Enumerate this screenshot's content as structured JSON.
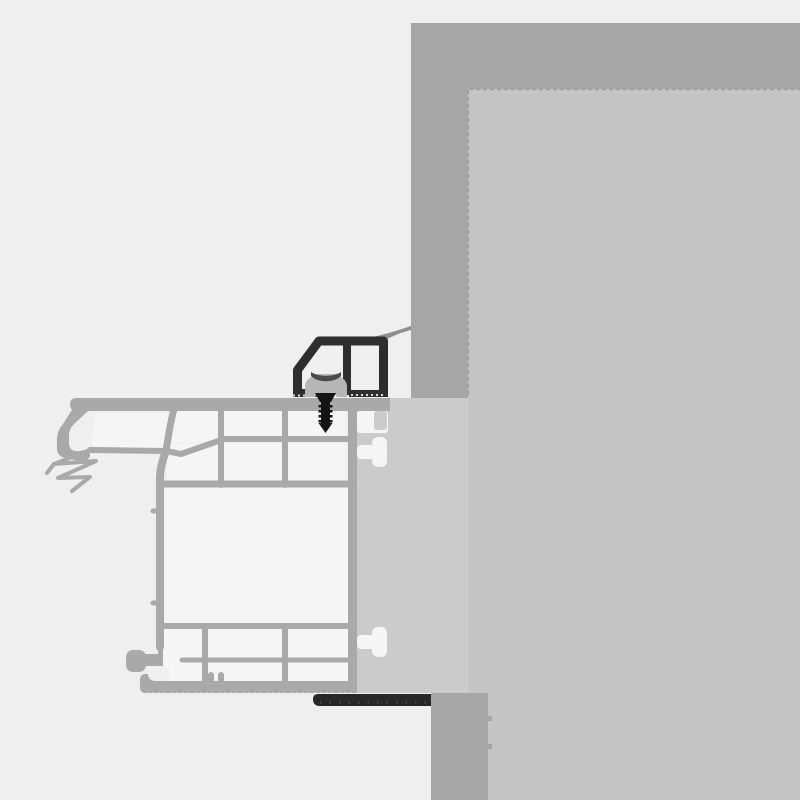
{
  "diagram": {
    "title": "Window frame to wall installation cross-section",
    "type": "technical-section-drawing",
    "text_labels": [],
    "components": [
      {
        "id": "wall",
        "label": "masonry wall"
      },
      {
        "id": "wall-reveal-band",
        "label": "wall reveal plaster band"
      },
      {
        "id": "gap-filler",
        "label": "installation gap filler between frame and wall"
      },
      {
        "id": "window-frame-profile",
        "label": "multi-chamber window frame profile"
      },
      {
        "id": "rebate-gasket",
        "label": "rebate sealing gasket"
      },
      {
        "id": "mounting-bracket",
        "label": "installation mounting bracket"
      },
      {
        "id": "adjustment-block",
        "label": "adjustment block inside bracket"
      },
      {
        "id": "fixing-screw",
        "label": "fixing screw through frame"
      },
      {
        "id": "sealing-lip",
        "label": "sealing lip against wall"
      },
      {
        "id": "base-seal-strip",
        "label": "base sealing strip under frame"
      }
    ],
    "colors": {
      "background": "#efefef",
      "wall_band": "#a6a6a6",
      "wall_fill": "#c4c4c4",
      "gap_fill": "#cbcbcb",
      "profile": "#a9a9a9",
      "chamber": "#f5f5f5",
      "bracket": "#2e2e2e",
      "clip": "#b6b6b6",
      "clip_shadow": "#4a4a4a",
      "screw": "#141414",
      "seal_strip": "#282828",
      "seal_lip": "#8f8f8f",
      "edge_line": "#9a9a9a"
    }
  }
}
